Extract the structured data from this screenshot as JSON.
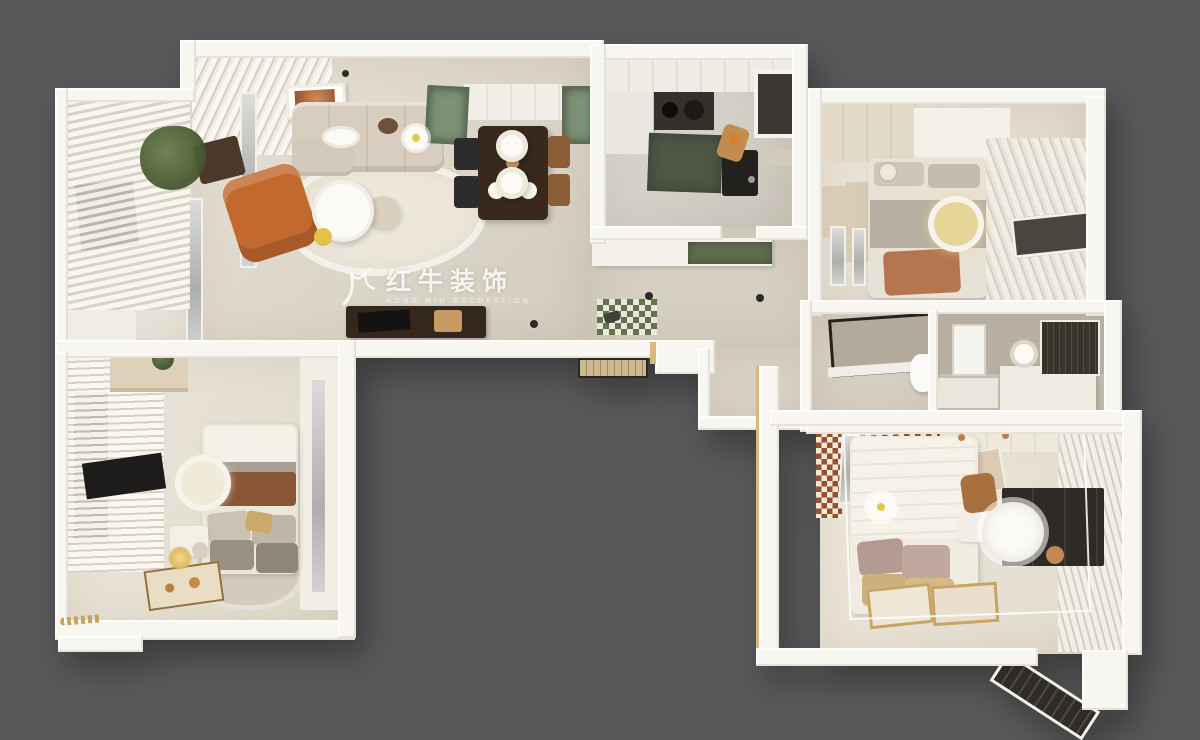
{
  "watermark": {
    "brand_cn": "红牛装饰",
    "brand_en": "HONG NIU DECORATION",
    "logo": "hongniu-bull-logo"
  },
  "palette": {
    "background": "#59595b",
    "wall_white": "#f8f6f0",
    "floor_warm": "#ddd7ca",
    "floor_light": "#eae5d9",
    "bath_floor": "#c6c0b4",
    "accent_orange": "#c2692f",
    "accent_terracotta": "#b5764f",
    "sage_green_cabinet": "#7d9176",
    "dark_green_counter": "#5d6c4c",
    "dark_wood": "#33271e",
    "checker_green": "#62734d",
    "checker_brown": "#94502f",
    "gold_trim": "#d9b87c",
    "lamp_yellow": "#e8d79a"
  }
}
